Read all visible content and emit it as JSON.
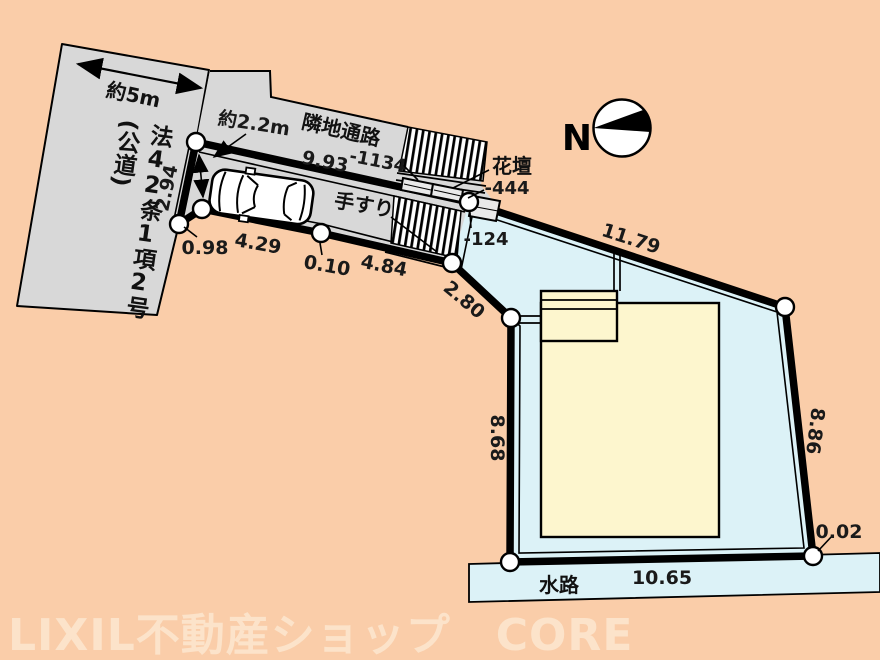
{
  "road": {
    "name": "法42条1項2号",
    "name_paren": "(公道)",
    "width_label": "約5m"
  },
  "passage": {
    "label": "隣地通路",
    "entrance_width": "約2.2m",
    "elevation": "-1134"
  },
  "stairs": {
    "handrail_label": "手すり",
    "flowerbed_label": "花壇",
    "mid_elevation": "-444",
    "lower_elevation": "-124"
  },
  "dims": {
    "passage_length": "9.93",
    "road_frontage": "2.94",
    "seg_a": "0.98",
    "seg_b": "4.29",
    "seg_c": "0.10",
    "seg_d": "4.84",
    "seg_e": "2.80",
    "north_edge": "11.79",
    "east_edge": "8.86",
    "jog": "0.02",
    "south_edge": "10.65",
    "west_edge": "8.68"
  },
  "waterway": {
    "label": "水路"
  },
  "compass": {
    "north_label": "N"
  },
  "watermark": {
    "text": "LIXIL不動産ショップ　CORE"
  },
  "colors": {
    "background": "#facda9",
    "road_gray": "#d8d8d8",
    "lot_cyan": "#dcf2f7",
    "house_cream": "#fdf6ce",
    "line_black": "#000000",
    "watermark": "#fce3ca"
  }
}
